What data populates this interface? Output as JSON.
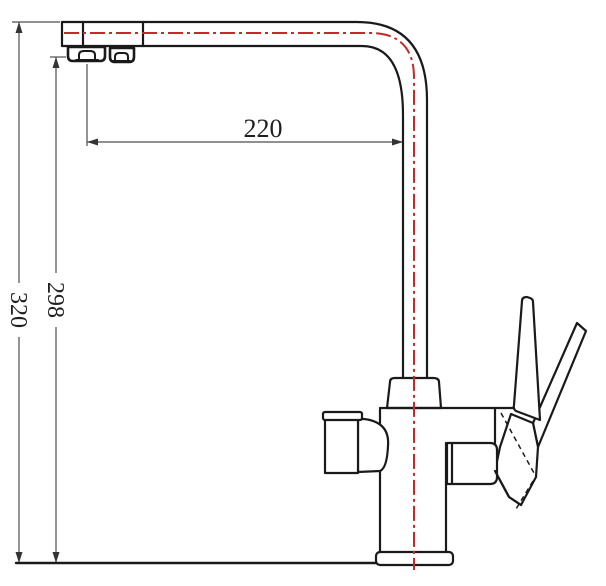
{
  "drawing": {
    "kind": "faucet-dimension-drawing",
    "dimensions": {
      "spout_reach": "220",
      "total_height": "320",
      "spout_height": "298"
    },
    "colors": {
      "object_line": "#1a1a1a",
      "hidden_line": "#1a1a1a",
      "dimension_line": "#4d4d4d",
      "arrow_fill": "#333333",
      "centerline": "#c22b2b",
      "text": "#1f1f1f",
      "background": "#ffffff"
    }
  }
}
